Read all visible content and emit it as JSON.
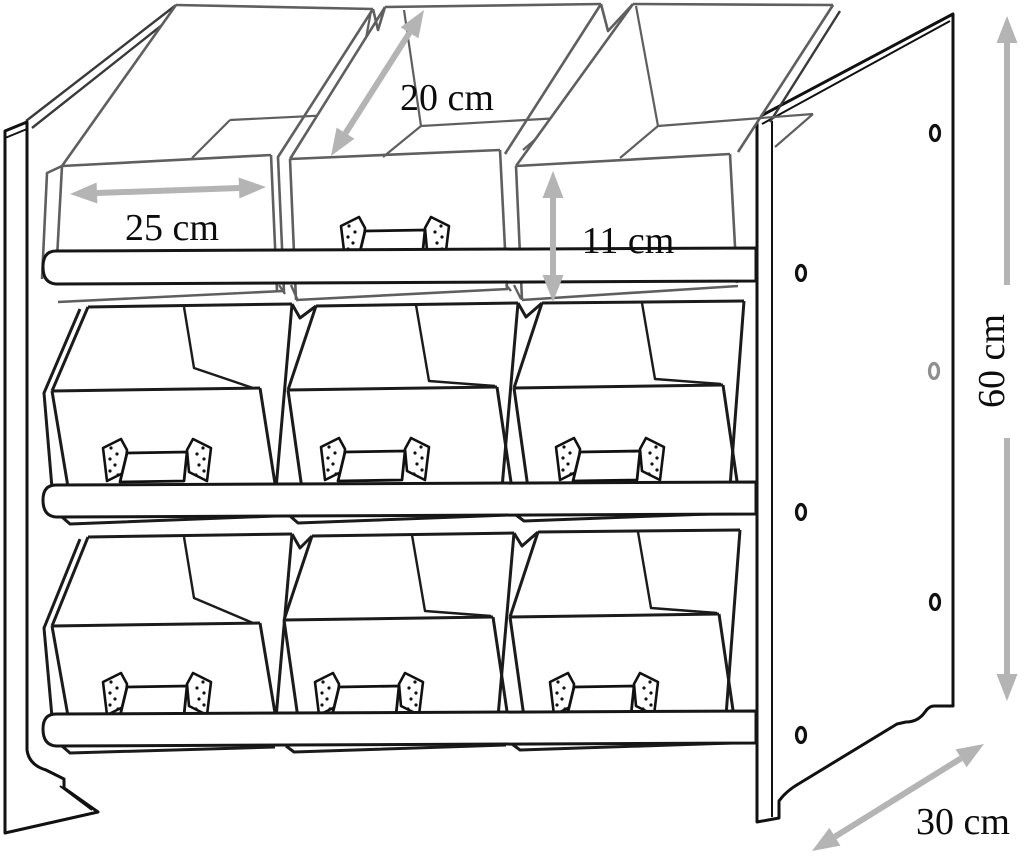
{
  "diagram": {
    "type": "technical-dimension-drawing",
    "subject": "9-bin storage organizer unit (3 rows x 3 fabric bins on wooden frame)",
    "dimensions": {
      "bin_depth": {
        "label": "20 cm",
        "value": 20,
        "unit": "cm",
        "orientation": "diagonal-depth",
        "applies_to": "bin depth (top middle bin)"
      },
      "bin_width": {
        "label": "25 cm",
        "value": 25,
        "unit": "cm",
        "orientation": "horizontal",
        "applies_to": "bin width (top left bin)"
      },
      "bin_height": {
        "label": "11 cm",
        "value": 11,
        "unit": "cm",
        "orientation": "vertical",
        "applies_to": "bin height (top right bin)"
      },
      "unit_height": {
        "label": "60 cm",
        "value": 60,
        "unit": "cm",
        "orientation": "vertical-right-side",
        "applies_to": "overall unit height"
      },
      "unit_depth": {
        "label": "30 cm",
        "value": 30,
        "unit": "cm",
        "orientation": "diagonal-bottom-right",
        "applies_to": "overall unit depth"
      }
    },
    "structure": {
      "rows": 3,
      "bins_per_row": 3,
      "front_rails": 3,
      "handles_visible": 7,
      "side_panel_pegs": 6
    },
    "colors": {
      "background": "#ffffff",
      "frame_line": "#111111",
      "bin_line": "#1b1b1b",
      "top_row_line": "#5f5f5f",
      "arrow": "#b4b4b4",
      "text": "#0c0c0c"
    }
  }
}
